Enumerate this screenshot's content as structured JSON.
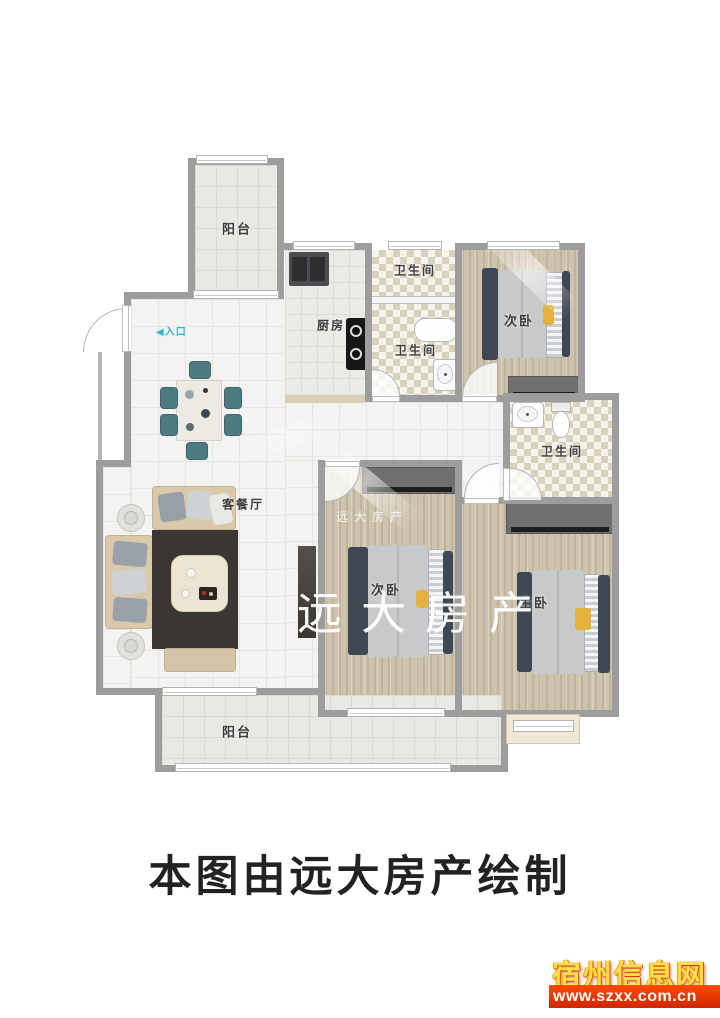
{
  "rooms": {
    "balcony_top": "阳台",
    "balcony_bottom": "阳台",
    "kitchen": "厨房",
    "bath_top": "卫生间",
    "bath_mid": "卫生间",
    "bath_right": "卫生间",
    "bedroom_top_right": "次卧",
    "bedroom_bottom_left": "次卧",
    "bedroom_master": "主卧",
    "living": "客餐厅",
    "entrance": "入口"
  },
  "icons": {
    "entrance_arrow": "◀"
  },
  "watermark": {
    "brand_large": "远大房产",
    "brand_small": "远大房产"
  },
  "caption": "本图由远大房产绘制",
  "footer_logo": {
    "site_name": "宿州信息网",
    "site_url": "www.szxx.com.cn"
  },
  "colors": {
    "wall_gray": "#9d9d9d",
    "wood_floor": "#cec3ac",
    "checker_tile": "#d8d1bb",
    "living_tile": "#f4f3f1",
    "bed_frame": "#3e4754",
    "mattress": "#c7c9cb",
    "accent_yellow": "#e2b23c",
    "chair_teal": "#4d7b82",
    "rug_dark": "#3a3733",
    "sofa_tan": "#d9c8aa",
    "entrance_cyan": "#2fb3d6",
    "logo_gold": "#ffdf4d",
    "banner_red": "#e23000"
  }
}
